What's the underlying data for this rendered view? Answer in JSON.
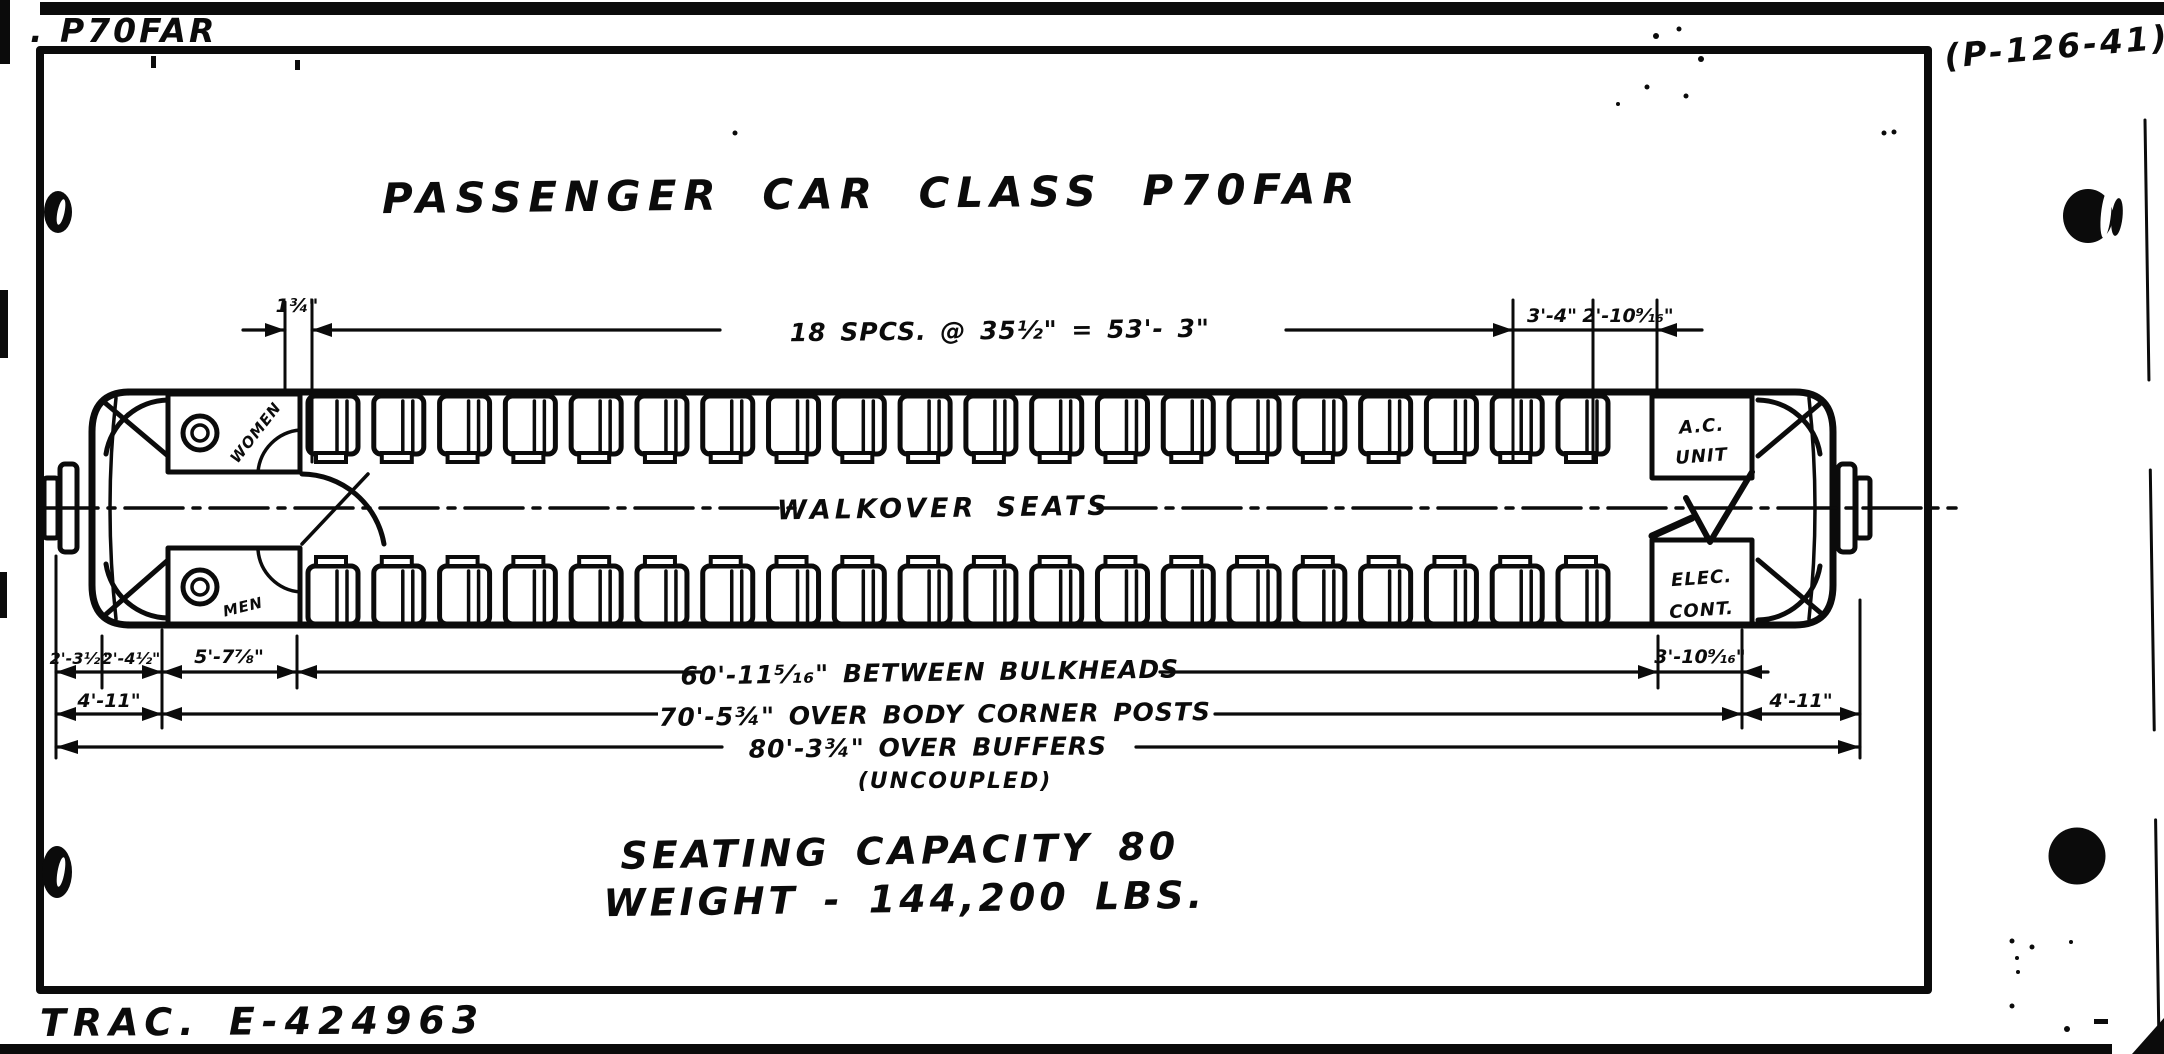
{
  "page": {
    "class_label": ". P70FAR",
    "drawing_number": "(P-126-41)",
    "tracing_number": "TRAC. E-424963"
  },
  "title": "PASSENGER CAR CLASS P70FAR",
  "car": {
    "center_label": "WALKOVER SEATS",
    "room_women": "WOMEN",
    "room_men": "MEN",
    "ac_unit": [
      "A.C.",
      "UNIT"
    ],
    "elec_cont": [
      "ELEC.",
      "CONT."
    ],
    "seats_per_row": 20,
    "rows": 2
  },
  "dimensions": {
    "top_small_left": "1¾\"",
    "seat_spacing": "18 SPCS. @ 35½\" = 53'- 3\"",
    "top_right_a": "3'-4\"",
    "top_right_b": "2'-10⁹⁄₁₆\"",
    "bottom_left_a": "2'-3½\"",
    "bottom_left_b": "2'-4½\"",
    "bottom_left_c": "5'-7⅞\"",
    "between_bulkheads": "60'-11⁵⁄₁₆\" BETWEEN BULKHEADS",
    "bottom_right_a": "3'-10⁹⁄₁₆\"",
    "left_end": "4'-11\"",
    "over_corner_posts": "70'-5¾\" OVER BODY CORNER POSTS",
    "right_end": "4'-11\"",
    "over_buffers": "80'-3¾\" OVER BUFFERS",
    "over_buffers_note": "(UNCOUPLED)"
  },
  "stats": {
    "seating_capacity": "SEATING CAPACITY 80",
    "weight": "WEIGHT - 144,200 LBS."
  },
  "colors": {
    "ink": "#0b0b0b",
    "paper": "#ffffff"
  }
}
